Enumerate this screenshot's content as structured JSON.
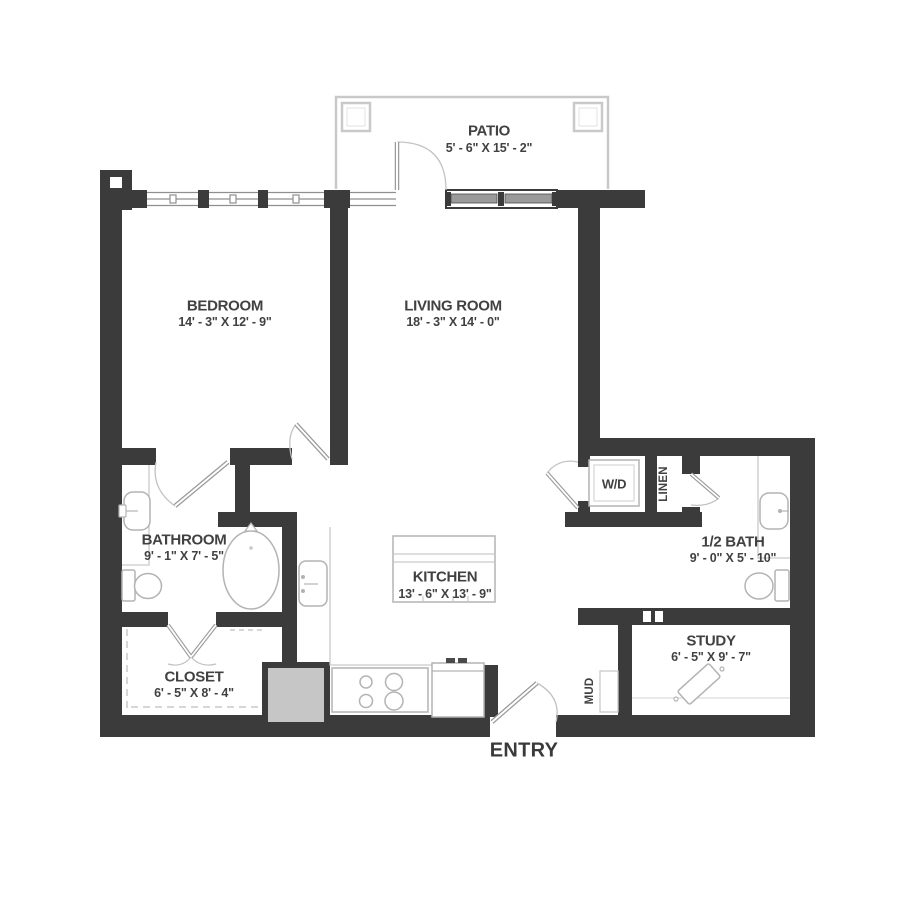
{
  "colors": {
    "wall": "#3b3b3b",
    "text": "#414141",
    "fixture_line": "#b3b3b3",
    "patio_outline": "#c9c9c9",
    "glazing": "#9a9a9a",
    "pantry_fill": "#c6c6c6"
  },
  "rooms": {
    "patio": {
      "label": "PATIO",
      "dims": "5' - 6\" X 15' - 2\""
    },
    "bedroom": {
      "label": "BEDROOM",
      "dims": "14' - 3\" X 12' - 9\""
    },
    "living_room": {
      "label": "LIVING ROOM",
      "dims": "18' - 3\" X 14' - 0\""
    },
    "bathroom": {
      "label": "BATHROOM",
      "dims": "9' - 1\" X 7' - 5\""
    },
    "kitchen": {
      "label": "KITCHEN",
      "dims": "13' - 6\" X 13' - 9\""
    },
    "closet": {
      "label": "CLOSET",
      "dims": "6' - 5\" X 8' - 4\""
    },
    "half_bath": {
      "label": "1/2 BATH",
      "dims": "9' - 0\" X 5' - 10\""
    },
    "study": {
      "label": "STUDY",
      "dims": "6' - 5\" X 9' - 7\""
    },
    "wd": {
      "label": "W/D"
    },
    "linen": {
      "label": "LINEN"
    },
    "mud": {
      "label": "MUD"
    },
    "entry": {
      "label": "ENTRY"
    }
  }
}
